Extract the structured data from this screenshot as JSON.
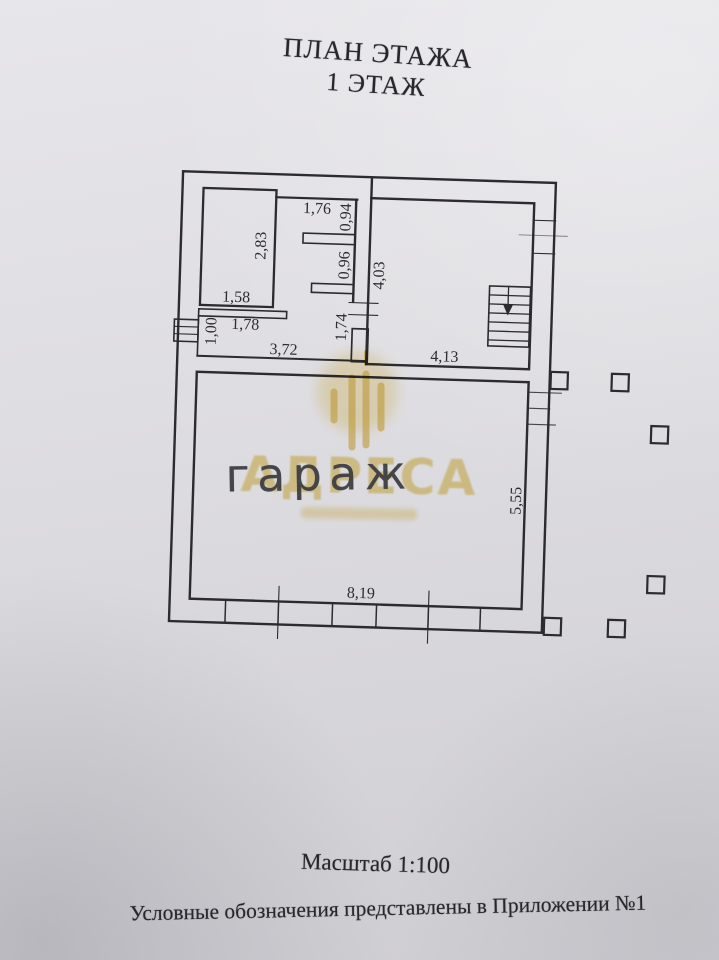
{
  "document": {
    "title_line1": "ПЛАН ЭТАЖА",
    "title_line2": "1 ЭТАЖ",
    "scale_label": "Масштаб 1:100",
    "legend_note": "Условные обозначения представлены в Приложении №1"
  },
  "plan": {
    "room_label": "гараж",
    "dimensions": {
      "d283": "2,83",
      "d158": "1,58",
      "d176": "1,76",
      "d094": "0,94",
      "d096": "0,96",
      "d100": "1,00",
      "d178": "1,78",
      "d372": "3,72",
      "d174": "1,74",
      "d403": "4,03",
      "d413": "4,13",
      "d819": "8,19",
      "d555": "5,55"
    }
  },
  "watermark": {
    "brand": "АДРЕСА"
  },
  "colors": {
    "ink": "#2b2b30",
    "paper": "#dcdbdf",
    "watermark_gold": "#dfba3e",
    "handwriting": "#3b3b3f"
  }
}
